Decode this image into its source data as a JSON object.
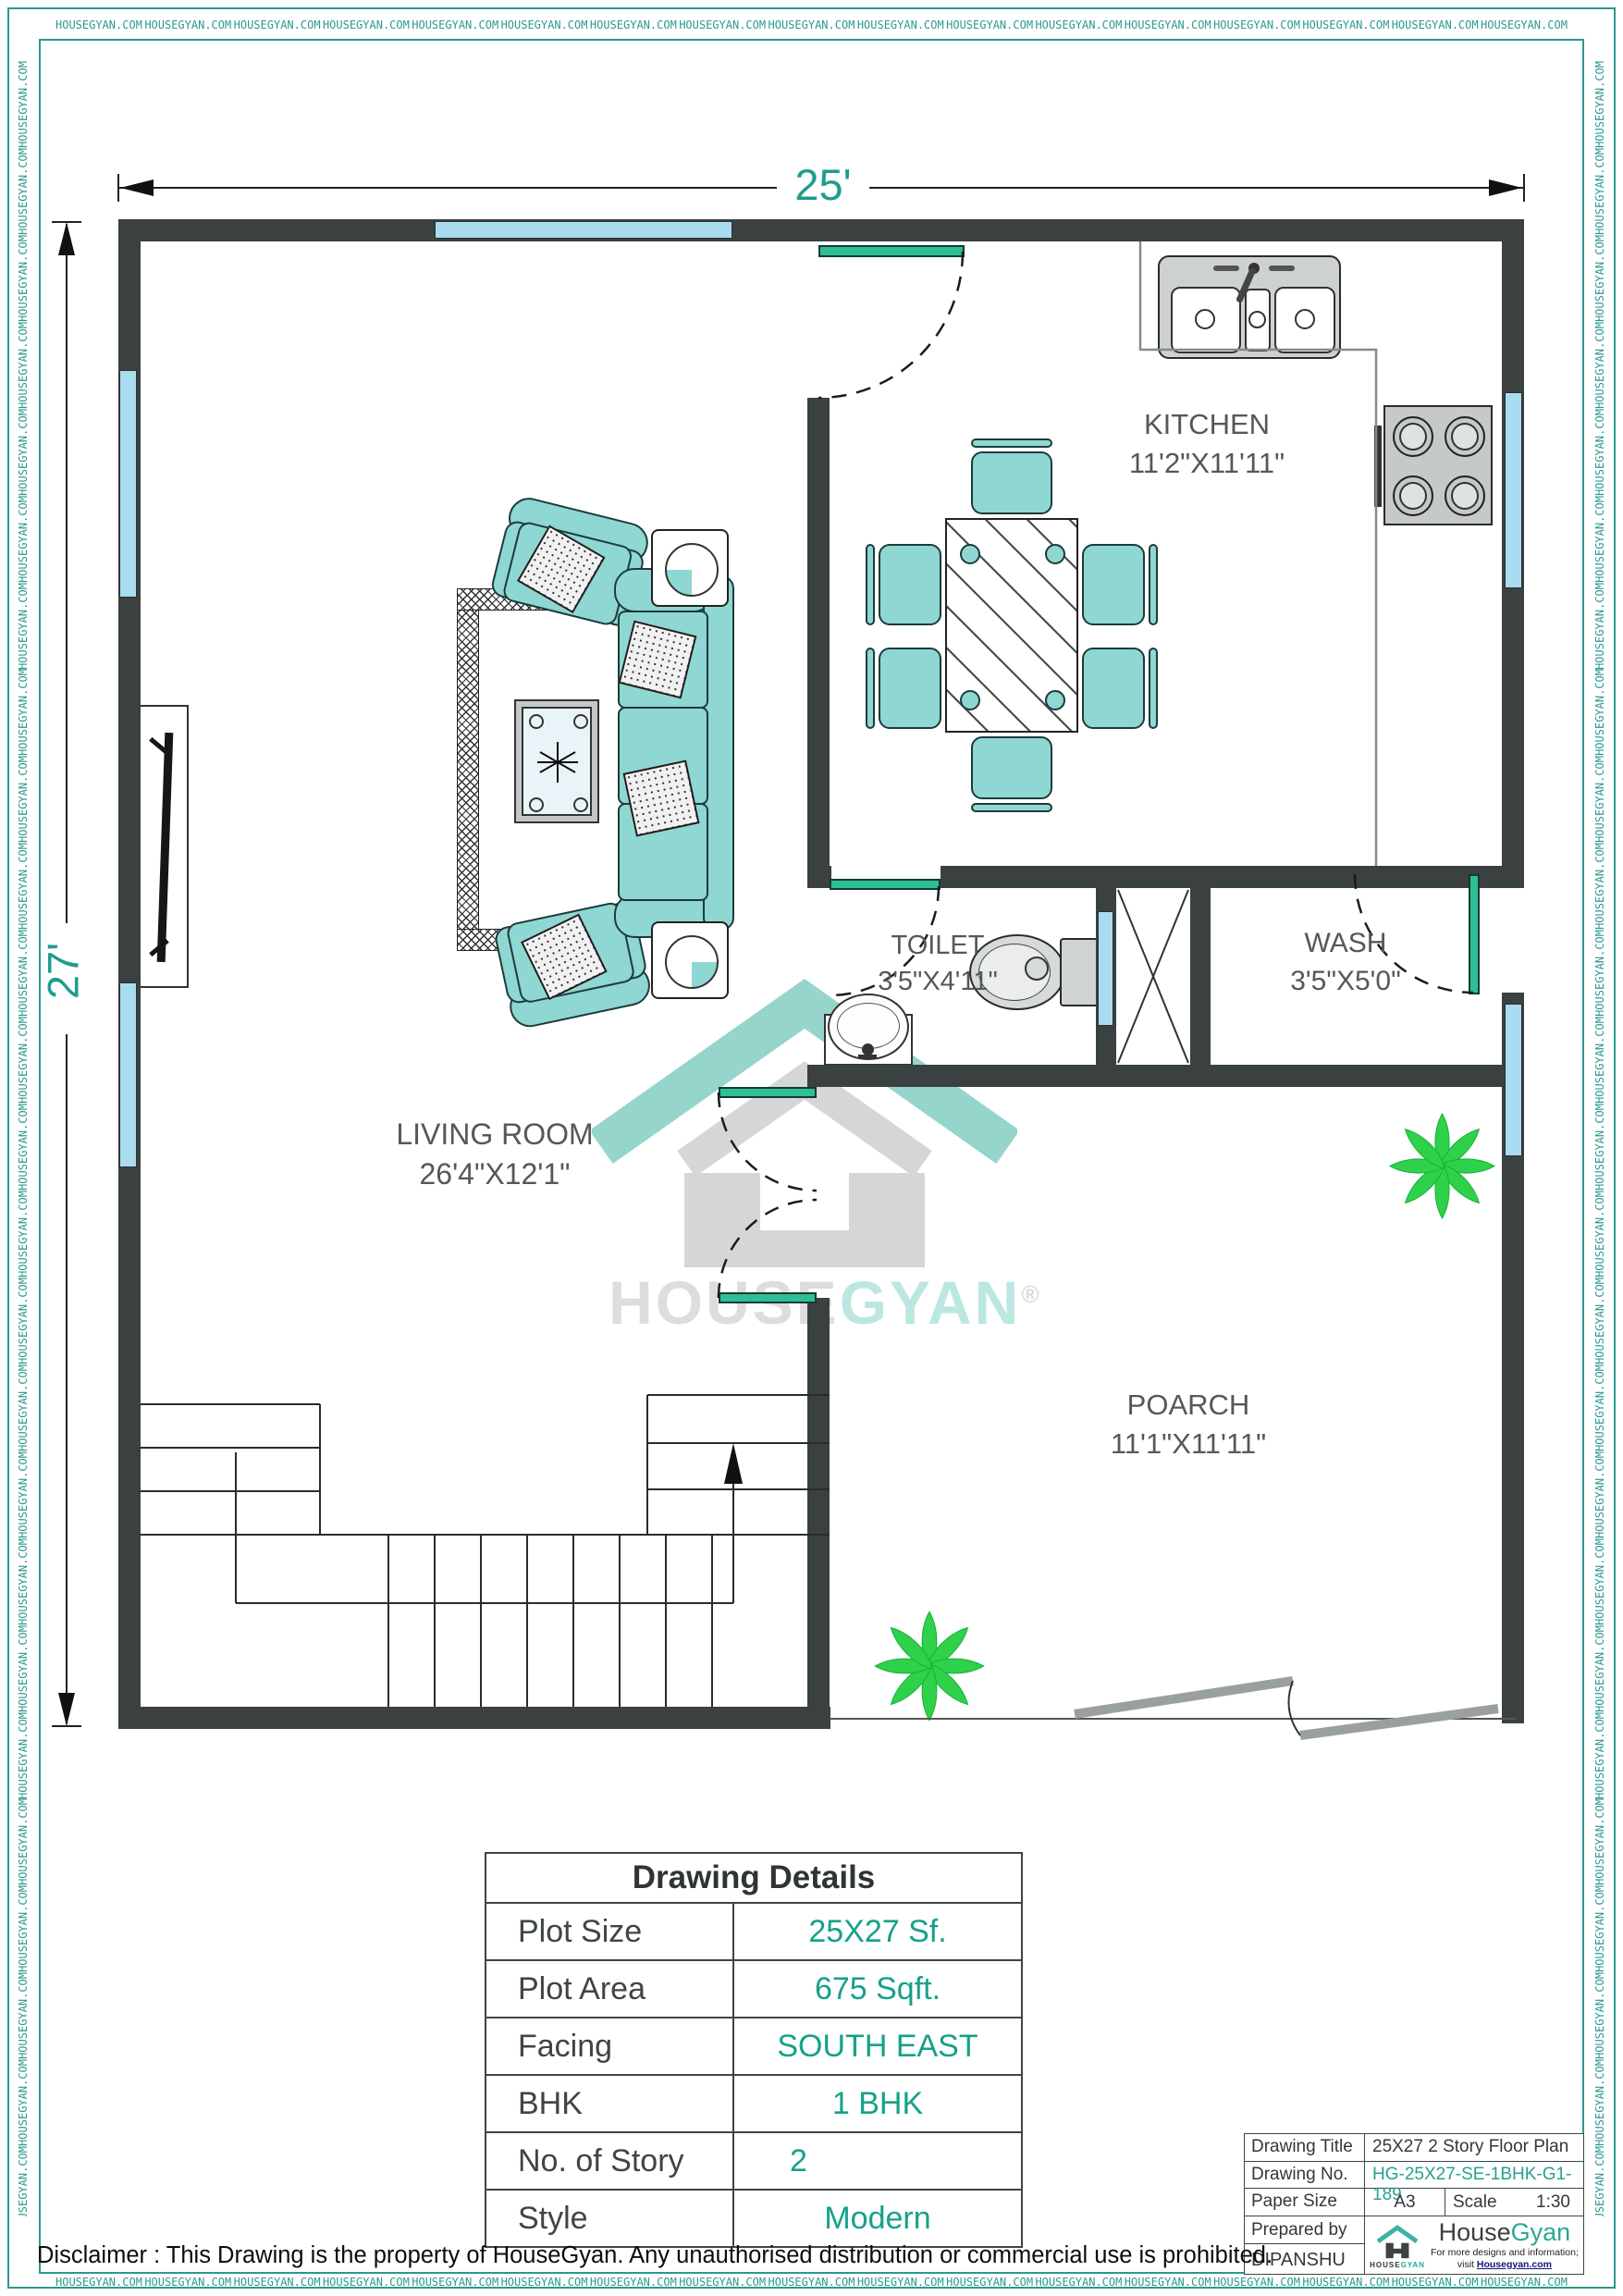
{
  "border": {
    "watermark_text": "HOUSEGYAN.COM",
    "top_count": 17,
    "bottom_count": 17,
    "left_count": 26,
    "right_count": 26
  },
  "dimensions": {
    "top": "25'",
    "left": "27'"
  },
  "rooms": {
    "kitchen": {
      "name": "KITCHEN",
      "size": "11'2\"X11'11\""
    },
    "toilet": {
      "name": "TOILET",
      "size": "3'5\"X4'11\""
    },
    "wash": {
      "name": "WASH",
      "size": "3'5\"X5'0\""
    },
    "living": {
      "name": "LIVING ROOM",
      "size": "26'4\"X12'1\""
    },
    "porch": {
      "name": "POARCH",
      "size": "11'1\"X11'11\""
    }
  },
  "watermark": {
    "brand_gray": "HOUSE",
    "brand_teal": "GYAN",
    "registered": "®"
  },
  "details_table": {
    "title": "Drawing Details",
    "rows": [
      {
        "label": "Plot Size",
        "value": "25X27 Sf."
      },
      {
        "label": "Plot Area",
        "value": "675 Sqft."
      },
      {
        "label": "Facing",
        "value": "SOUTH EAST"
      },
      {
        "label": "BHK",
        "value": "1 BHK"
      },
      {
        "label": "No. of Story",
        "value": "2"
      },
      {
        "label": "Style",
        "value": "Modern"
      }
    ]
  },
  "title_block": {
    "drawing_title_label": "Drawing Title",
    "drawing_title": "25X27 2 Story  Floor Plan",
    "drawing_no_label": "Drawing No.",
    "drawing_no": "HG-25X27-SE-1BHK-G1-189",
    "paper_size_label": "Paper Size",
    "paper_size": "A3",
    "scale_label": "Scale",
    "scale": "1:30",
    "prepared_by_label": "Prepared by",
    "prepared_by": "DIPANSHU",
    "brand": {
      "name_gray": "House",
      "name_teal": "Gyan",
      "tagline1": "For more designs and information;",
      "tagline2": "visit ",
      "link": "Housegyan.com",
      "logo_text_gray": "HOUSE",
      "logo_text_teal": "GYAN"
    }
  },
  "disclaimer": "Disclaimer : This Drawing is the property of HouseGyan. Any unauthorised distribution or commercial use is prohibited."
}
